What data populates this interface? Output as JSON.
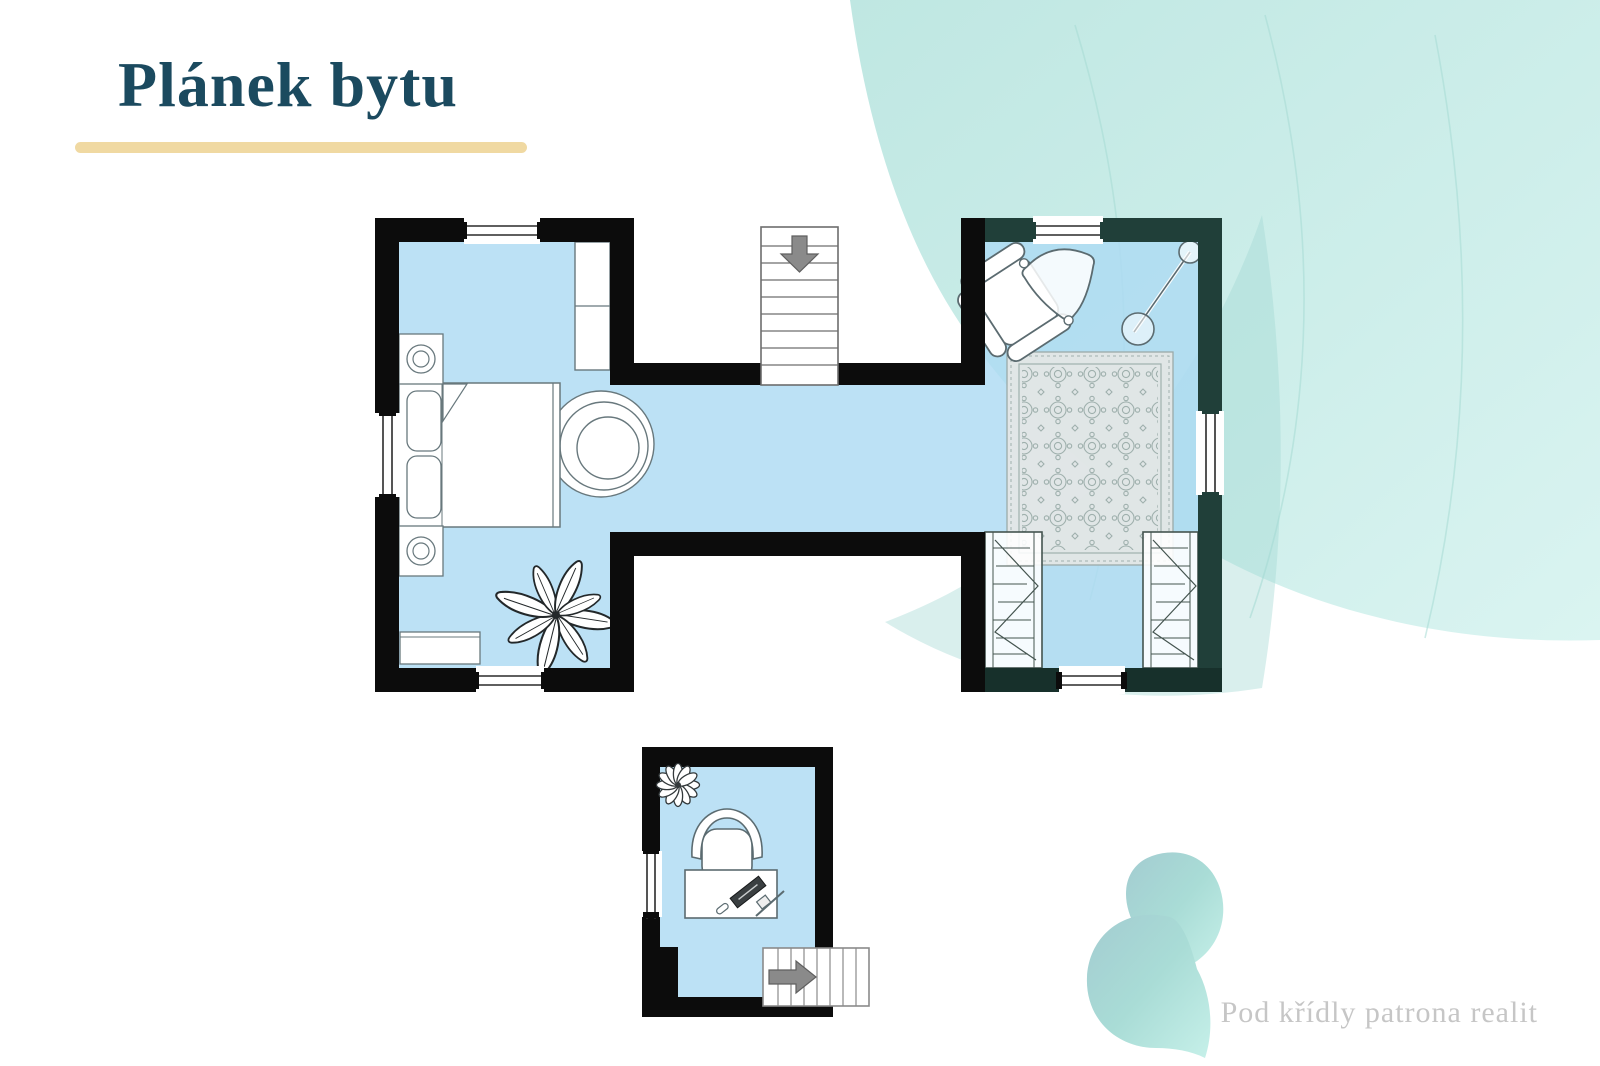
{
  "slide": {
    "title": "Plánek bytu",
    "footer": "Pod křídly patrona realit"
  },
  "colors": {
    "title_text": "#1b4a5f",
    "title_underline": "#f0d9a2",
    "room_floor": "#c7e8f7",
    "walls": "#0c0c0c",
    "walls_teal_tinted": "#203f39",
    "swoosh_teal": "#c8ebe7",
    "swoosh_tint_wedge": "#9fd8d1",
    "logo_teal": "#a9d8d5",
    "footer_text": "#c6c6c6",
    "stairs_arrow_gray": "#8a8a8a"
  },
  "floorplan": {
    "left_room_furniture": [
      "double-bed",
      "pillow",
      "pillow",
      "blanket-fold",
      "nightstand-with-lamp",
      "nightstand-with-lamp",
      "tall-cabinet",
      "papasan-round-chair",
      "palm-plant",
      "low-dresser"
    ],
    "hallway_features": [
      "staircase"
    ],
    "hallway_stairs_arrow_direction": "down",
    "right_room_furniture": [
      "armchair",
      "lounge-cone-chair",
      "floor-lamp",
      "ornamental-rug",
      "open-wardrobe-left",
      "open-wardrobe-right"
    ],
    "bottom_room_furniture": [
      "flower-plant",
      "office-chair",
      "desk",
      "keyboard",
      "desk-accessories",
      "staircase"
    ],
    "bottom_room_stairs_arrow_direction": "right",
    "window_count": 7
  }
}
